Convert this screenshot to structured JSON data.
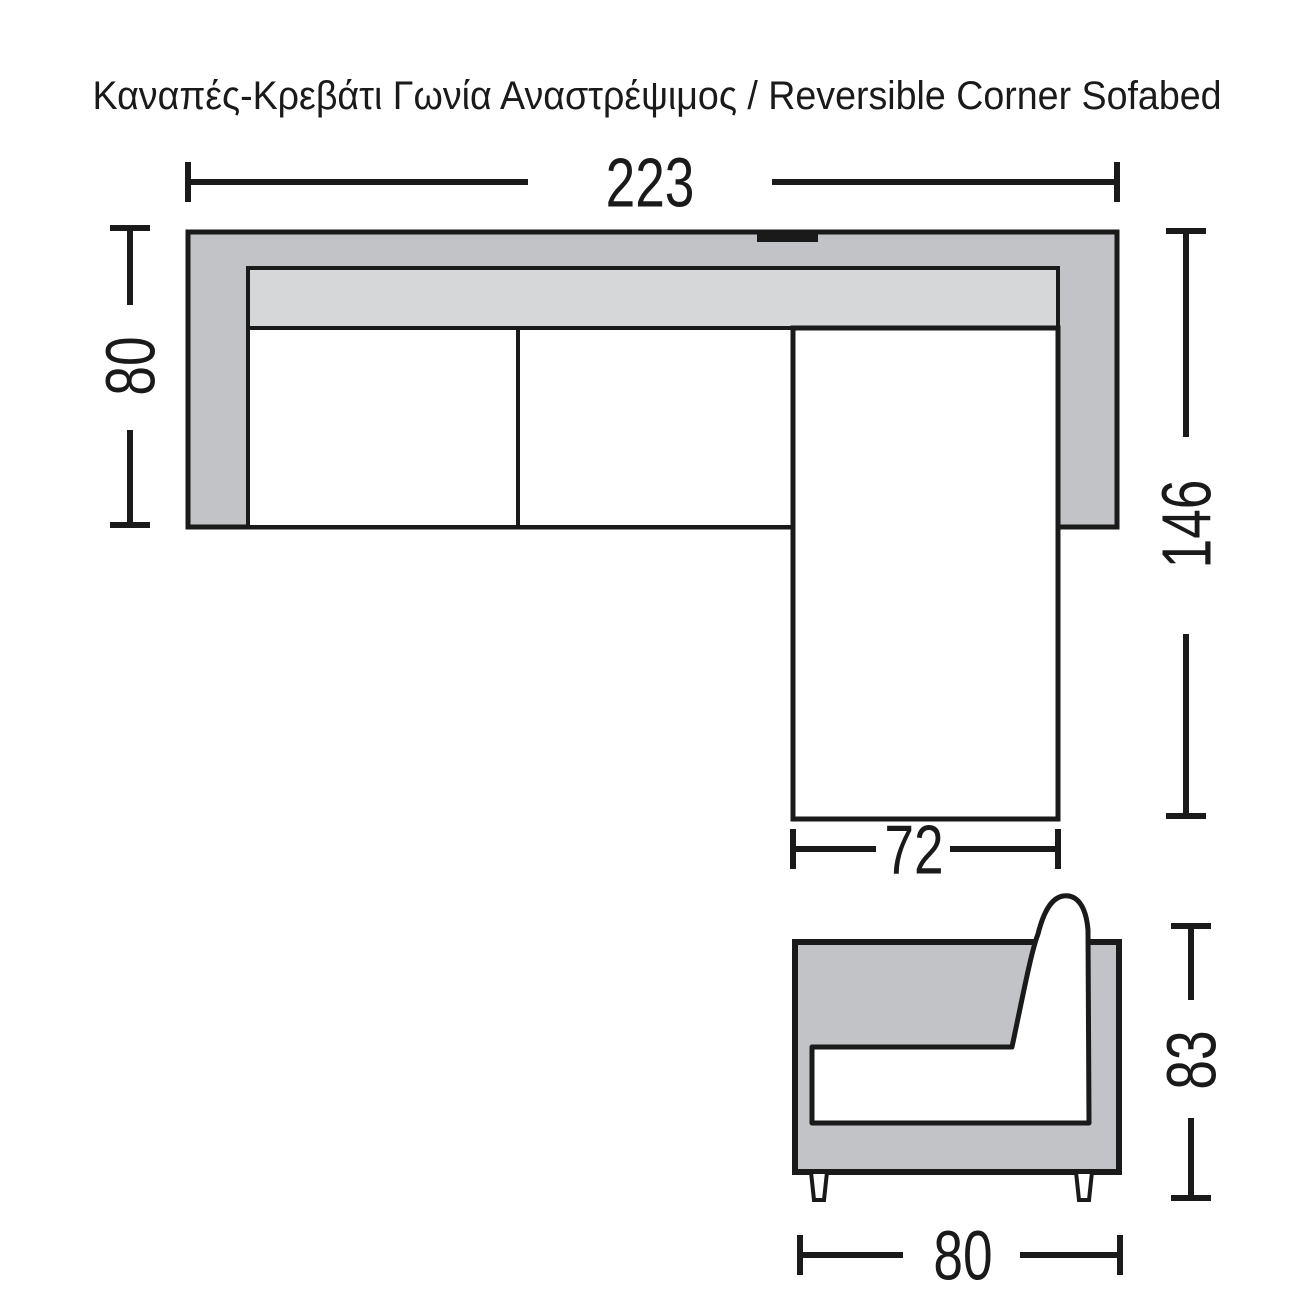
{
  "title": "Καναπές-Κρεβάτι Γωνία Αναστρέψιμος / Reversible Corner Sofabed",
  "views": {
    "top_view": "top view of corner sofabed",
    "side_view": "side view of sofabed"
  },
  "dims": {
    "sofa_width": "223",
    "sofa_depth": "80",
    "chaise_depth": "146",
    "chaise_width": "72",
    "side_height": "83",
    "side_depth": "80"
  },
  "colors": {
    "body_gray": "#c1c3c7",
    "cushion_gray": "#d6d7d9",
    "line_black": "#1a1a1a",
    "seat_white": "#ffffff"
  }
}
